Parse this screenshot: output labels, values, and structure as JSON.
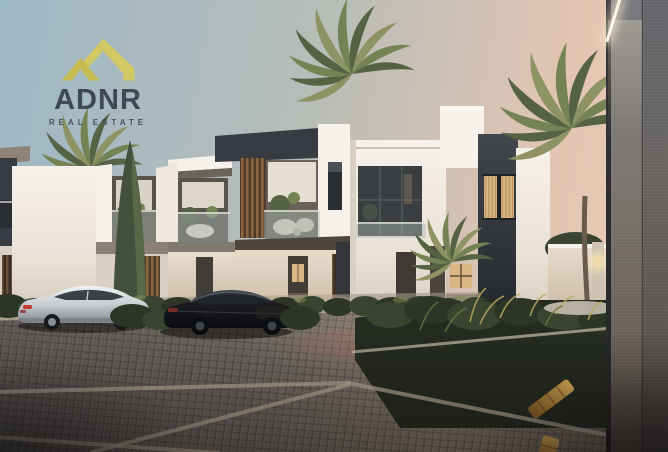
{
  "logo": {
    "brand": "ADNR",
    "tagline": "REAL ESTATE",
    "icon": "roof-chevrons-icon"
  },
  "palette": {
    "logo_gold": "#d3c964",
    "logo_text": "#3d4a54",
    "sky_top": "#9db8c6",
    "sky_mid": "#b9bdb8",
    "sky_horizon": "#e2c5b2",
    "building_white": "#efe8df",
    "accent_charcoal": "#383c42",
    "wood_louver": "#8a653f",
    "window_glow": "#d9b684",
    "foliage_dark": "#556244",
    "foliage_light": "#8d9362",
    "pavement_base": "#6c6560",
    "curb_light": "#b7ab99",
    "speed_bump": "#c9973c",
    "wall_grey": "#7a7b7f",
    "car_silver": "#c9cdd1",
    "car_black": "#15171b"
  }
}
